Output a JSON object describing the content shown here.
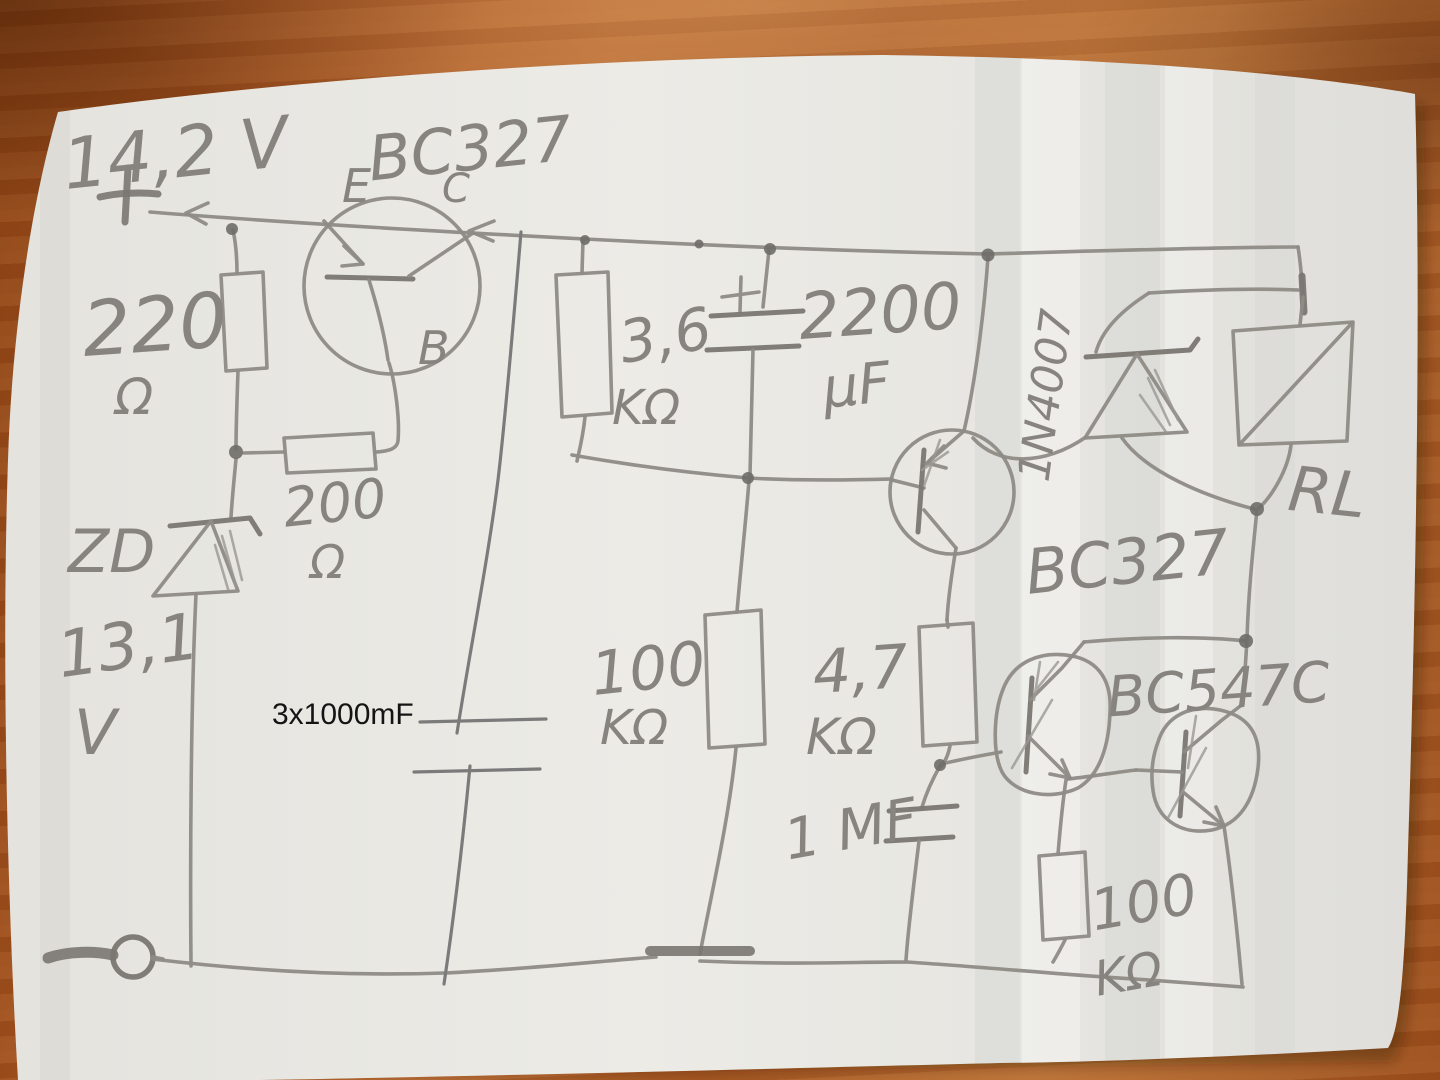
{
  "photo": {
    "description": "hand-drawn pencil circuit schematic on white paper on a wooden table"
  },
  "supply": {
    "voltage": "14,2 V",
    "plus_sign": "+",
    "minus_sign": "—"
  },
  "transistors": {
    "t1": {
      "part": "BC327",
      "emitter": "E",
      "collector": "C",
      "base": "B"
    },
    "t2": {
      "part": "BC327"
    },
    "t3_t4": {
      "part": "BC547C"
    }
  },
  "resistors": {
    "r1": {
      "value": "220",
      "unit": "Ω"
    },
    "r2": {
      "value": "200",
      "unit": "Ω"
    },
    "r3": {
      "value": "3,6",
      "unit": "KΩ"
    },
    "r4": {
      "value": "100",
      "unit": "KΩ"
    },
    "r5": {
      "value": "4,7",
      "unit": "KΩ"
    },
    "r6": {
      "value": "100",
      "unit": "KΩ"
    }
  },
  "capacitors": {
    "c1": {
      "value": "2200",
      "unit": "µF",
      "polarity": "+"
    },
    "c2": {
      "value": "1 MF"
    }
  },
  "diodes": {
    "zener": {
      "name": "ZD",
      "value": "13,1",
      "unit": "V"
    },
    "d1": {
      "part": "1N4007"
    }
  },
  "relay": {
    "name": "RL"
  },
  "digital_annotation": {
    "text": "3x1000mF"
  }
}
